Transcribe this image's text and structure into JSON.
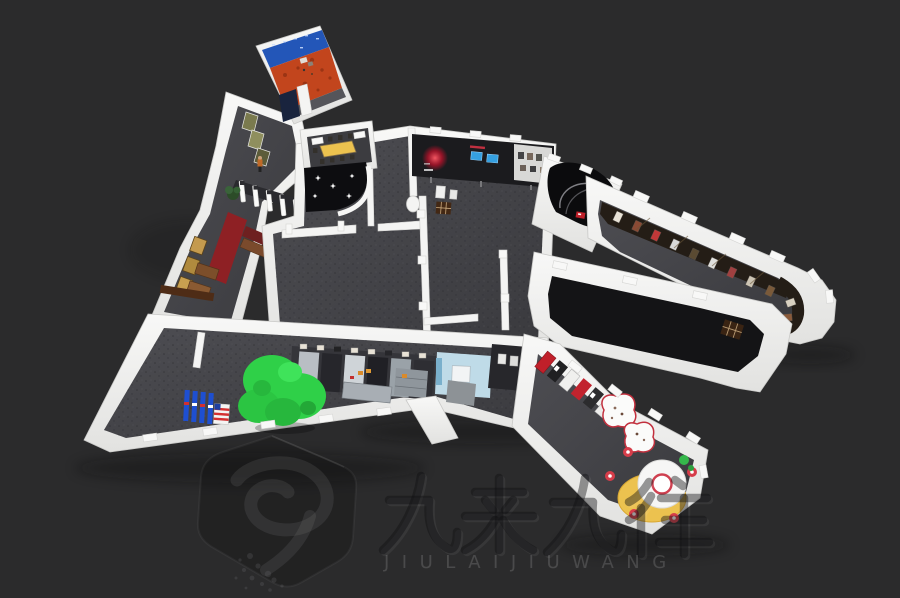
{
  "watermark": {
    "title": "九来九往",
    "subtitle": "JIULAIJIUWANG",
    "logo_icon": "hexagon-badge-nine"
  },
  "palette": {
    "background": "#2b2b2c",
    "wall": "#f0f0ef",
    "carpet": "#46464a",
    "black_floor": "#141416",
    "theme_orange": "#c2451d",
    "theme_blue_wall": "#2356b8",
    "screen_blue": "#35a0e0",
    "accent_red": "#c0202a",
    "tree_green": "#2fd048",
    "banner_blue": "#1e4fd0",
    "alcove_blue": "#bfdbe8",
    "table_yellow": "#ecc24f",
    "carpet_red": "#8e2024",
    "gold": "#c49a4e"
  },
  "features": [
    "entrance-gates",
    "meeting-room",
    "theme-room",
    "immersive-dome",
    "exhibit-corridor",
    "green-tree",
    "round-service-table"
  ]
}
